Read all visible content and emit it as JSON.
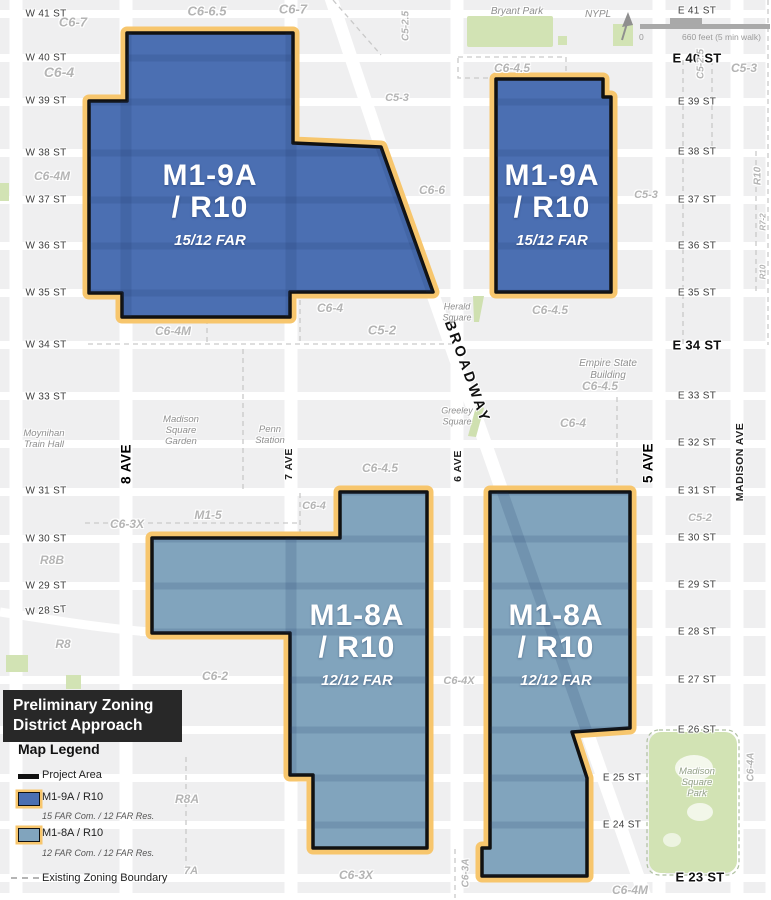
{
  "legend": {
    "title_line1": "Preliminary Zoning",
    "title_line2": "District Approach",
    "heading": "Map Legend",
    "project_area": "Project Area",
    "m19a_label": "M1-9A / R10",
    "m19a_far": "15 FAR Com. / 12 FAR Res.",
    "m18a_label": "M1-8A / R10",
    "m18a_far": "12 FAR Com. / 12 FAR Res.",
    "existing_boundary": "Existing Zoning Boundary"
  },
  "scalebar": {
    "zero": "0",
    "label": "660 feet (5 min walk)"
  },
  "colors": {
    "m19a": "#4b6fb2",
    "m18a": "#81a4bd",
    "highlight": "#f7c66d",
    "boundary": "#111111",
    "park": "#d2e3b4",
    "block": "#efeff0"
  },
  "districts": [
    {
      "name": "M1-9A",
      "sub": "/ R10",
      "far": "15/12 FAR",
      "x": 210,
      "y": 182
    },
    {
      "name": "M1-9A",
      "sub": "/ R10",
      "far": "15/12 FAR",
      "x": 552,
      "y": 182
    },
    {
      "name": "M1-8A",
      "sub": "/ R10",
      "far": "12/12 FAR",
      "x": 357,
      "y": 622
    },
    {
      "name": "M1-8A",
      "sub": "/ R10",
      "far": "12/12 FAR",
      "x": 556,
      "y": 622
    }
  ],
  "map": {
    "streets_west": [
      {
        "t": "W 41 ST",
        "y": 14
      },
      {
        "t": "W 40 ST",
        "y": 58
      },
      {
        "t": "W 39 ST",
        "y": 101
      },
      {
        "t": "W 38 ST",
        "y": 153
      },
      {
        "t": "W 37 ST",
        "y": 200
      },
      {
        "t": "W 36 ST",
        "y": 246
      },
      {
        "t": "W 35 ST",
        "y": 293
      },
      {
        "t": "W 34 ST",
        "y": 345
      },
      {
        "t": "W 33 ST",
        "y": 397
      },
      {
        "t": "W 31 ST",
        "y": 491
      },
      {
        "t": "W 30 ST",
        "y": 539
      },
      {
        "t": "W 29 ST",
        "y": 586
      },
      {
        "t": "W 28 ST",
        "y": 611,
        "r": -4
      }
    ],
    "streets_east": [
      {
        "t": "E 41 ST",
        "y": 11
      },
      {
        "t": "E 40 ST",
        "y": 58,
        "b": 1
      },
      {
        "t": "E 39 ST",
        "y": 102
      },
      {
        "t": "E 38 ST",
        "y": 152
      },
      {
        "t": "E 37 ST",
        "y": 200
      },
      {
        "t": "E 36 ST",
        "y": 246
      },
      {
        "t": "E 35 ST",
        "y": 293
      },
      {
        "t": "E 34 ST",
        "y": 345,
        "b": 1
      },
      {
        "t": "E 33 ST",
        "y": 396
      },
      {
        "t": "E 32 ST",
        "y": 443
      },
      {
        "t": "E 31 ST",
        "y": 491
      },
      {
        "t": "E 30 ST",
        "y": 538
      },
      {
        "t": "E 29 ST",
        "y": 585
      },
      {
        "t": "E 28 ST",
        "y": 632
      },
      {
        "t": "E 27 ST",
        "y": 680
      },
      {
        "t": "E 26 ST",
        "y": 730
      },
      {
        "t": "E 25 ST",
        "y": 778,
        "x": 622
      },
      {
        "t": "E 24 ST",
        "y": 825,
        "x": 622
      },
      {
        "t": "E 23 ST",
        "y": 877,
        "b": 1,
        "x": 700
      }
    ],
    "avenues": [
      {
        "t": "8 AVE",
        "x": 126,
        "y": 464,
        "b": 1
      },
      {
        "t": "7 AVE",
        "x": 289,
        "y": 464
      },
      {
        "t": "6 AVE",
        "x": 458,
        "y": 466
      },
      {
        "t": "5 AVE",
        "x": 648,
        "y": 463,
        "b": 1
      },
      {
        "t": "MADISON AVE",
        "x": 740,
        "y": 462
      }
    ],
    "broadway": {
      "t": "BROADWAY",
      "x": 467,
      "y": 372,
      "angle": 70
    },
    "zones": [
      {
        "t": "C6-7",
        "x": 73,
        "y": 22,
        "s": 13
      },
      {
        "t": "C6-6.5",
        "x": 207,
        "y": 11,
        "s": 13
      },
      {
        "t": "C6-7",
        "x": 293,
        "y": 9,
        "s": 13
      },
      {
        "t": "C6-4",
        "x": 59,
        "y": 72,
        "s": 14
      },
      {
        "t": "C5-3",
        "x": 397,
        "y": 98,
        "s": 11
      },
      {
        "t": "C6-4M",
        "x": 52,
        "y": 176,
        "s": 12
      },
      {
        "t": "C6-6",
        "x": 432,
        "y": 190,
        "s": 12
      },
      {
        "t": "C6-4.5",
        "x": 512,
        "y": 68,
        "s": 12
      },
      {
        "t": "C5-3",
        "x": 744,
        "y": 68,
        "s": 12
      },
      {
        "t": "C5-3",
        "x": 646,
        "y": 195,
        "s": 11
      },
      {
        "t": "C5-2.5",
        "x": 406,
        "y": 26,
        "s": 10,
        "r": -90
      },
      {
        "t": "C5-2.5",
        "x": 701,
        "y": 64,
        "s": 10,
        "r": -90
      },
      {
        "t": "R10",
        "x": 758,
        "y": 176,
        "s": 10,
        "r": -90
      },
      {
        "t": "R7-2",
        "x": 763,
        "y": 222,
        "s": 8,
        "r": -90
      },
      {
        "t": "R10",
        "x": 763,
        "y": 272,
        "s": 8,
        "r": -90
      },
      {
        "t": "C6-4.5",
        "x": 550,
        "y": 310,
        "s": 12
      },
      {
        "t": "C6-4",
        "x": 330,
        "y": 308,
        "s": 12
      },
      {
        "t": "C5-2",
        "x": 382,
        "y": 330,
        "s": 13
      },
      {
        "t": "C6-4M",
        "x": 173,
        "y": 331,
        "s": 12
      },
      {
        "t": "C6-4.5",
        "x": 600,
        "y": 386,
        "s": 12
      },
      {
        "t": "C6-4",
        "x": 573,
        "y": 423,
        "s": 12
      },
      {
        "t": "C6-4.5",
        "x": 380,
        "y": 468,
        "s": 12
      },
      {
        "t": "C6-4",
        "x": 314,
        "y": 506,
        "s": 11
      },
      {
        "t": "M1-5",
        "x": 208,
        "y": 515,
        "s": 12
      },
      {
        "t": "C6-3X",
        "x": 127,
        "y": 524,
        "s": 12
      },
      {
        "t": "R8B",
        "x": 52,
        "y": 560,
        "s": 12
      },
      {
        "t": "R8",
        "x": 63,
        "y": 644,
        "s": 12
      },
      {
        "t": "C6-2",
        "x": 215,
        "y": 676,
        "s": 12
      },
      {
        "t": "C6-4X",
        "x": 459,
        "y": 681,
        "s": 11
      },
      {
        "t": "C5-2",
        "x": 700,
        "y": 518,
        "s": 11
      },
      {
        "t": "R8A",
        "x": 187,
        "y": 799,
        "s": 12
      },
      {
        "t": "7A",
        "x": 191,
        "y": 871,
        "s": 11
      },
      {
        "t": "C6-3X",
        "x": 356,
        "y": 875,
        "s": 12
      },
      {
        "t": "C6-4M",
        "x": 630,
        "y": 890,
        "s": 12
      },
      {
        "t": "C6-3A",
        "x": 466,
        "y": 873,
        "s": 10,
        "r": -90
      },
      {
        "t": "C6-4A",
        "x": 751,
        "y": 767,
        "s": 10,
        "r": -90
      }
    ],
    "places": [
      {
        "lines": [
          "Bryant Park"
        ],
        "x": 517,
        "y": 12,
        "s": 10
      },
      {
        "lines": [
          "NYPL"
        ],
        "x": 598,
        "y": 15,
        "s": 10
      },
      {
        "lines": [
          "Herald",
          "Square"
        ],
        "x": 457,
        "y": 312,
        "s": 9
      },
      {
        "lines": [
          "Greeley",
          "Square"
        ],
        "x": 457,
        "y": 416,
        "s": 9
      },
      {
        "lines": [
          "Empire State",
          "Building"
        ],
        "x": 608,
        "y": 370,
        "s": 10
      },
      {
        "lines": [
          "Madison",
          "Square",
          "Garden"
        ],
        "x": 181,
        "y": 431,
        "s": 9.5
      },
      {
        "lines": [
          "Penn",
          "Station"
        ],
        "x": 270,
        "y": 435,
        "s": 9.5
      },
      {
        "lines": [
          "Moynihan",
          "Train Hall"
        ],
        "x": 44,
        "y": 439,
        "s": 9.5
      },
      {
        "lines": [
          "Madison",
          "Square",
          "Park"
        ],
        "x": 697,
        "y": 783,
        "s": 9.5,
        "c": "#93a088"
      }
    ],
    "rows": [
      {
        "y": 14
      },
      {
        "y": 58
      },
      {
        "y": 102
      },
      {
        "y": 153
      },
      {
        "y": 200
      },
      {
        "y": 246
      },
      {
        "y": 293
      },
      {
        "y": 345
      },
      {
        "y": 396
      },
      {
        "y": 444
      },
      {
        "y": 492
      },
      {
        "y": 539
      },
      {
        "y": 586
      },
      {
        "y": 632,
        "x1": 140
      },
      {
        "y": 680
      },
      {
        "y": 730
      },
      {
        "y": 778
      },
      {
        "y": 825
      },
      {
        "y": 878
      },
      {
        "y": 897
      }
    ],
    "avenues_x": [
      16,
      126,
      291,
      457,
      659,
      737,
      772
    ],
    "broadway_path": "M330,-5 L381,147 L470,400 L648,905"
  }
}
